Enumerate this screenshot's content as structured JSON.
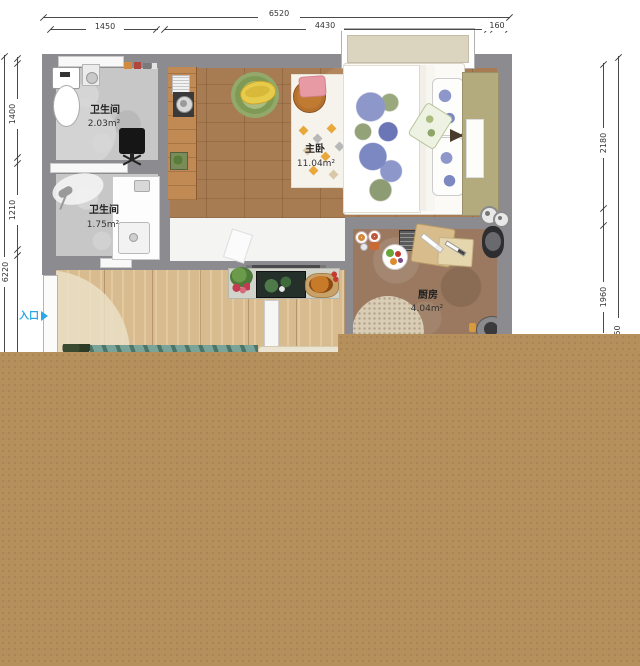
{
  "plan": {
    "dims_top": {
      "total": "6520",
      "seg1": "1450",
      "seg2": "4430",
      "seg3": "160"
    },
    "dims_left": {
      "total": "6220",
      "seg1": "1400",
      "seg2": "1210"
    },
    "dims_right": {
      "seg1": "2180",
      "seg2": "1960",
      "seg3": "150"
    },
    "rooms": {
      "bath1": {
        "name": "卫生间",
        "area": "2.03m²"
      },
      "bath2": {
        "name": "卫生间",
        "area": "1.75m²"
      },
      "bedroom": {
        "name": "主卧",
        "area": "11.04m²"
      },
      "kitchen": {
        "name": "厨房",
        "area": "4.04m²"
      }
    },
    "entrance_label": "入口",
    "furniture": [
      "toilet",
      "water-heater",
      "office-chair",
      "shower",
      "sink-cabinet",
      "washing-machine",
      "bookshelf",
      "desk-strip",
      "round-rug",
      "banana-bench",
      "hexagon-rug",
      "side-table",
      "pink-stool",
      "slippers",
      "double-bed",
      "pillows",
      "headboard",
      "nightstand",
      "window",
      "tv-console",
      "tv",
      "plant",
      "roast-dish",
      "dining-set",
      "cutting-boards",
      "fruit-plate",
      "pressure-cooker",
      "stove",
      "kitchen-rug",
      "sofa",
      "area-rug",
      "entrance-door"
    ],
    "colors": {
      "wall": "#8c8c90",
      "dim_line": "#4a4a4a",
      "tan_overlay": "#b5905c",
      "entrance_blue": "#2ba7e8",
      "bedroom_floor": "#a87c52",
      "living_floor": "#d8bc90",
      "kitchen_floor": "#9a7960"
    }
  }
}
